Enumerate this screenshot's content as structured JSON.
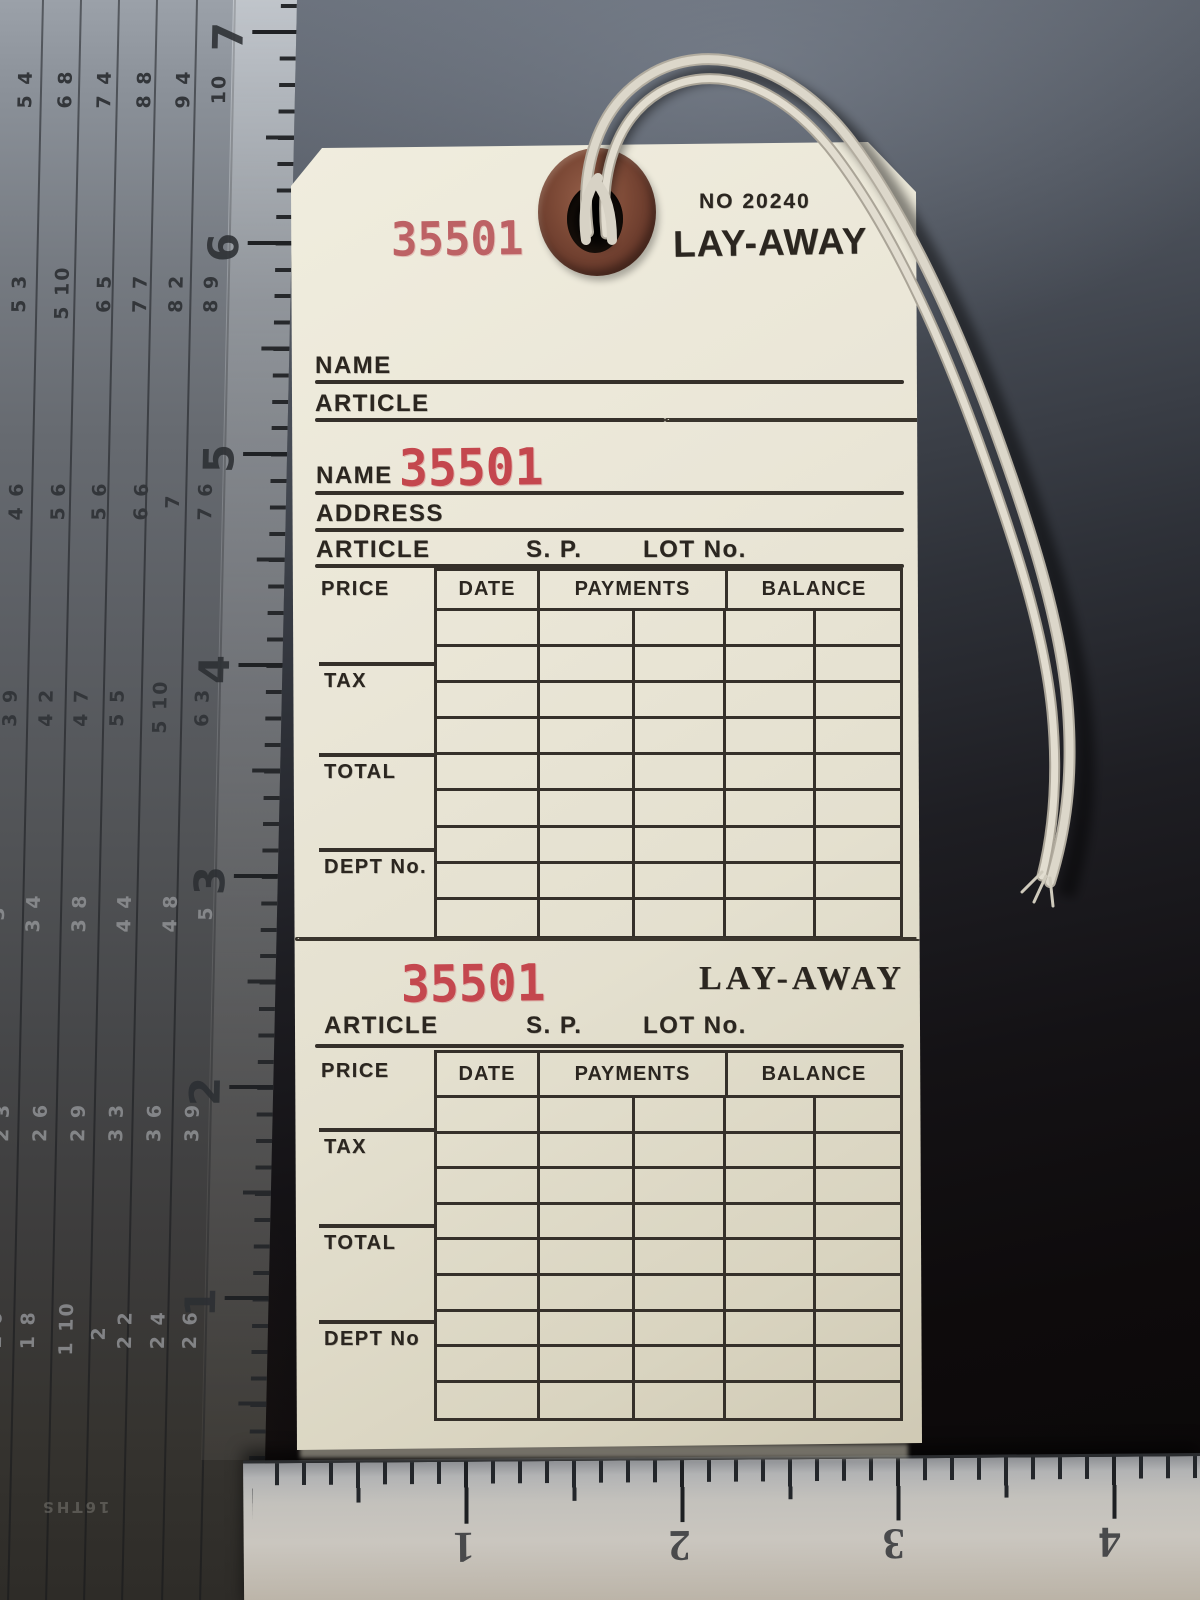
{
  "tag": {
    "serial": "35501",
    "no_number": "NO 20240",
    "title": "LAY-AWAY",
    "fields": {
      "name": "NAME",
      "address": "ADDRESS",
      "article": "ARTICLE",
      "sp": "S. P.",
      "lot": "LOT No.",
      "price": "PRICE",
      "tax": "TAX",
      "total": "TOTAL",
      "dept": "DEPT No.",
      "dept_alt": "DEPT No"
    },
    "table_headers": [
      "DATE",
      "PAYMENTS",
      "BALANCE"
    ]
  },
  "ruler_left": {
    "edge_numbers": [
      "7",
      "6",
      "5",
      "4",
      "3",
      "2",
      "1"
    ],
    "scale_label": "16THS",
    "rafter_groups": [
      {
        "y": 78,
        "tone": "dark",
        "values": [
          "5 4",
          "6 8",
          "7 4",
          "8 8",
          "9 4",
          "10"
        ]
      },
      {
        "y": 284,
        "tone": "dark",
        "values": [
          "5 3",
          "5 10",
          "6 5",
          "7 7",
          "8 2",
          "8 9"
        ]
      },
      {
        "y": 490,
        "tone": "dark",
        "values": [
          "4 6",
          "5 6",
          "5 6",
          "6 6",
          "7",
          "7 6"
        ]
      },
      {
        "y": 698,
        "tone": "dark",
        "values": [
          "3 9",
          "4 2",
          "4 7",
          "5 5",
          "5 10",
          "6 3"
        ]
      },
      {
        "y": 902,
        "tone": "lite",
        "values": [
          "3",
          "3 4",
          "3 8",
          "4 4",
          "4 8",
          "5"
        ]
      },
      {
        "y": 1112,
        "tone": "lite",
        "values": [
          "2 3",
          "2 6",
          "2 9",
          "3 3",
          "3 6",
          "3 9"
        ]
      },
      {
        "y": 1322,
        "tone": "lite",
        "values": [
          "1 6",
          "1 8",
          "1 10",
          "2",
          "2 2",
          "2 4",
          "2 6"
        ]
      }
    ]
  },
  "ruler_bottom": {
    "numbers": [
      "1",
      "2",
      "3",
      "4"
    ]
  },
  "colors": {
    "tag_paper": "#e9e5d6",
    "stamp_black": "#2b2620",
    "stamp_red": "#c4474e",
    "grommet_brown": "#6f4030",
    "string": "#d9d5c9",
    "steel_dark": "#4a4c4f",
    "steel_light": "#c3c1bc"
  }
}
